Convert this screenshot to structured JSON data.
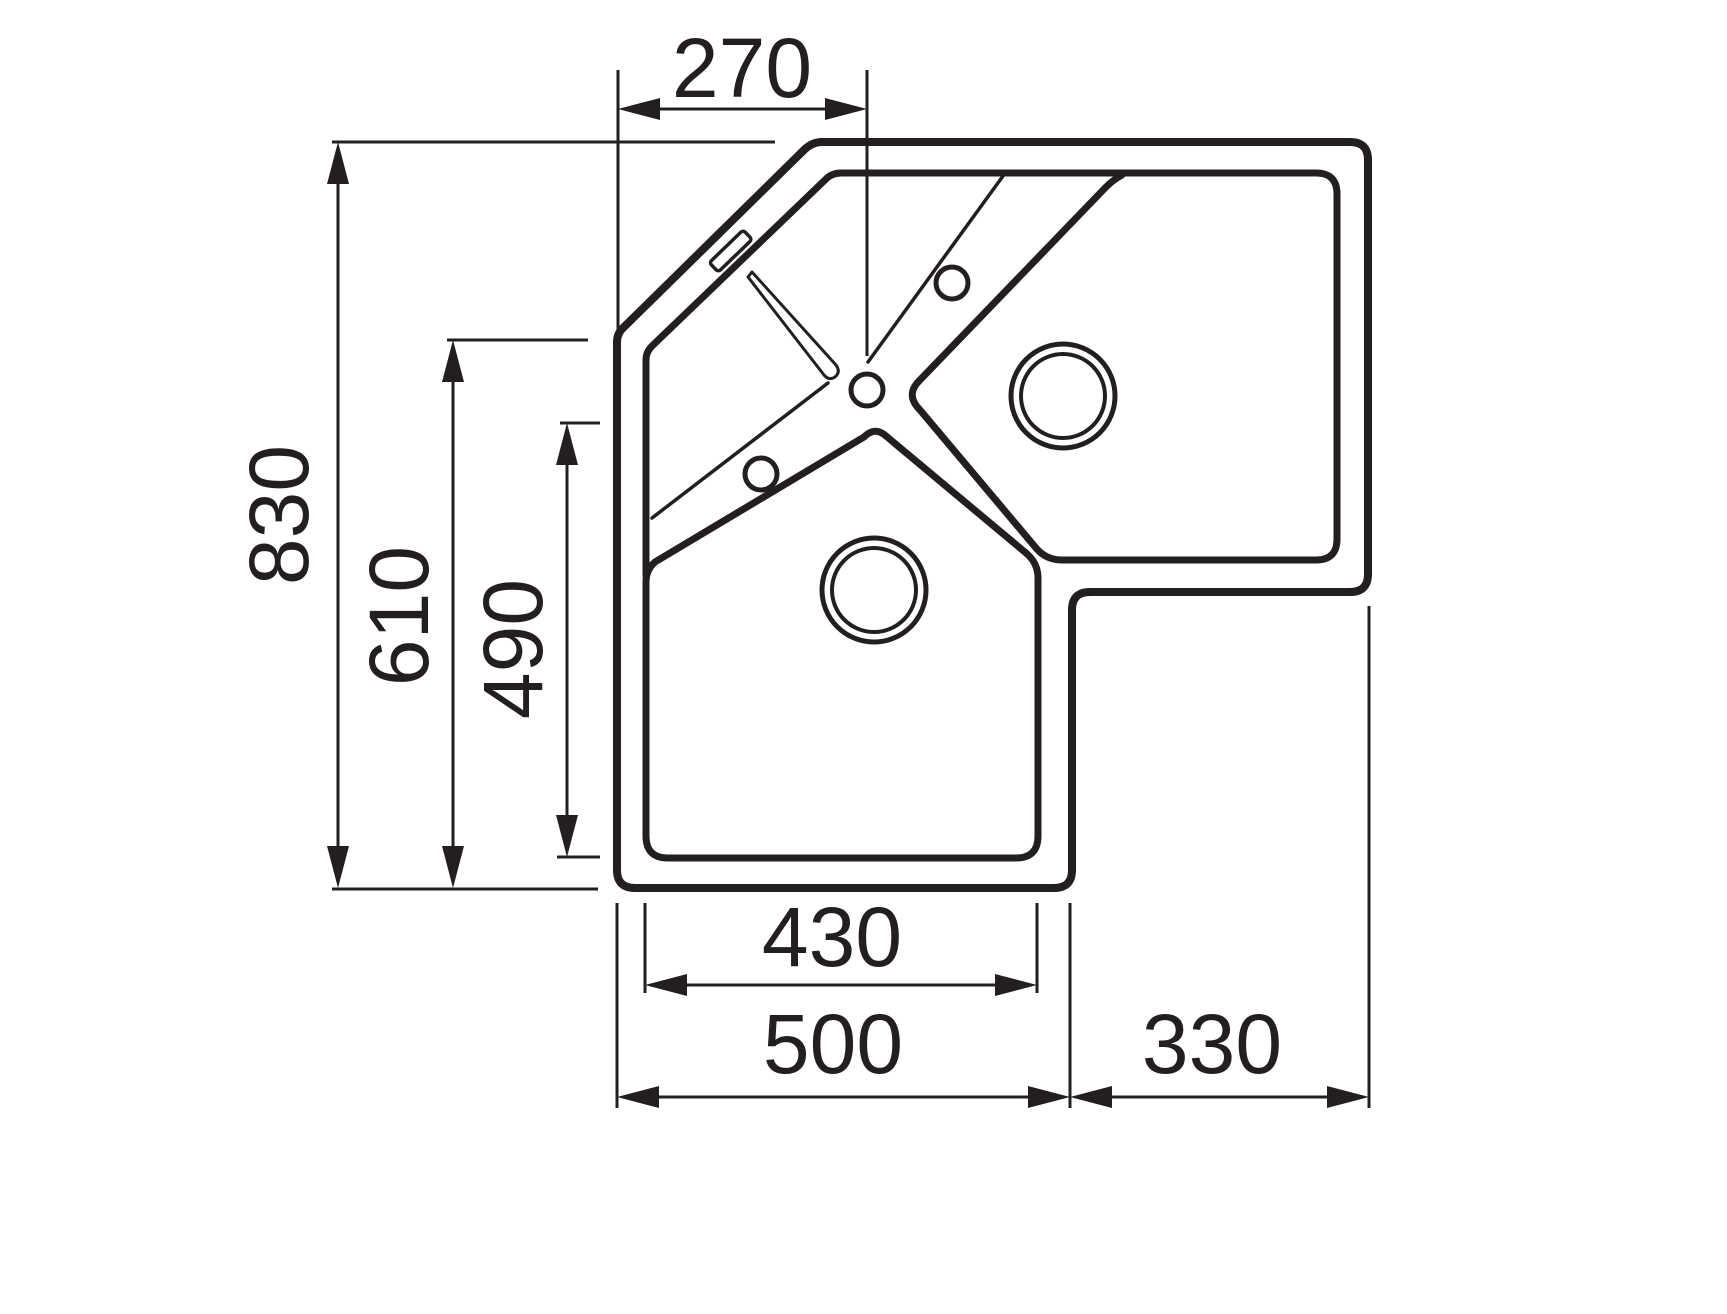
{
  "drawing": {
    "dims": {
      "top": "270",
      "left_outer": "830",
      "left_middle": "610",
      "left_inner": "490",
      "bottom_inner": "430",
      "bottom_left": "500",
      "bottom_right": "330"
    }
  },
  "colors": {
    "line": "#231f20",
    "background": "#ffffff"
  }
}
